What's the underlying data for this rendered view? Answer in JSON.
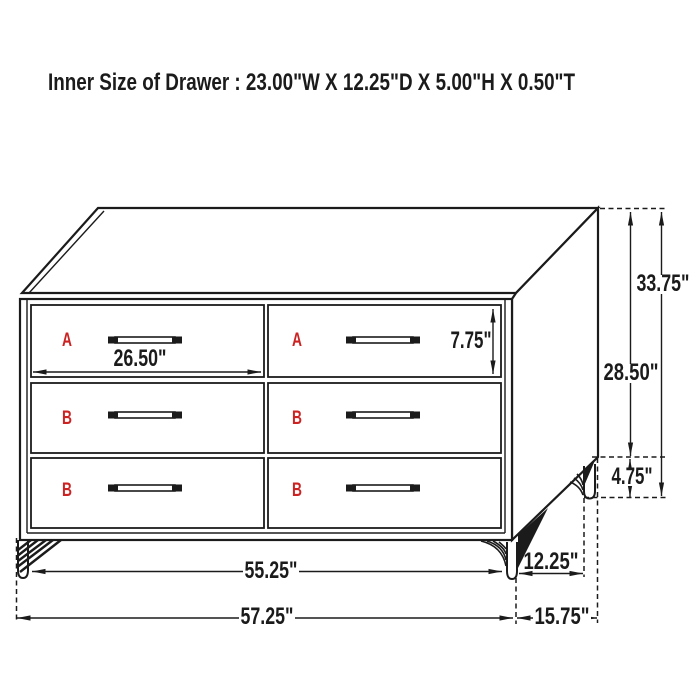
{
  "title": "Inner Size of Drawer : 23.00\"W X 12.25\"D X 5.00\"H X 0.50\"T",
  "drawers": {
    "top_left_label": "A",
    "top_right_label": "A",
    "middle_left_label": "B",
    "middle_right_label": "B",
    "bottom_left_label": "B",
    "bottom_right_label": "B"
  },
  "dimensions": {
    "drawer_front_width": "26.50\"",
    "drawer_front_height": "7.75\"",
    "overall_height": "33.75\"",
    "case_height": "28.50\"",
    "leg_height": "4.75\"",
    "leg_inset_depth": "12.25\"",
    "width_between_legs": "55.25\"",
    "overall_width": "57.25\"",
    "overall_depth": "15.75\""
  },
  "colors": {
    "line": "#1b1b1b",
    "label_red": "#cc2222",
    "background": "#ffffff"
  }
}
